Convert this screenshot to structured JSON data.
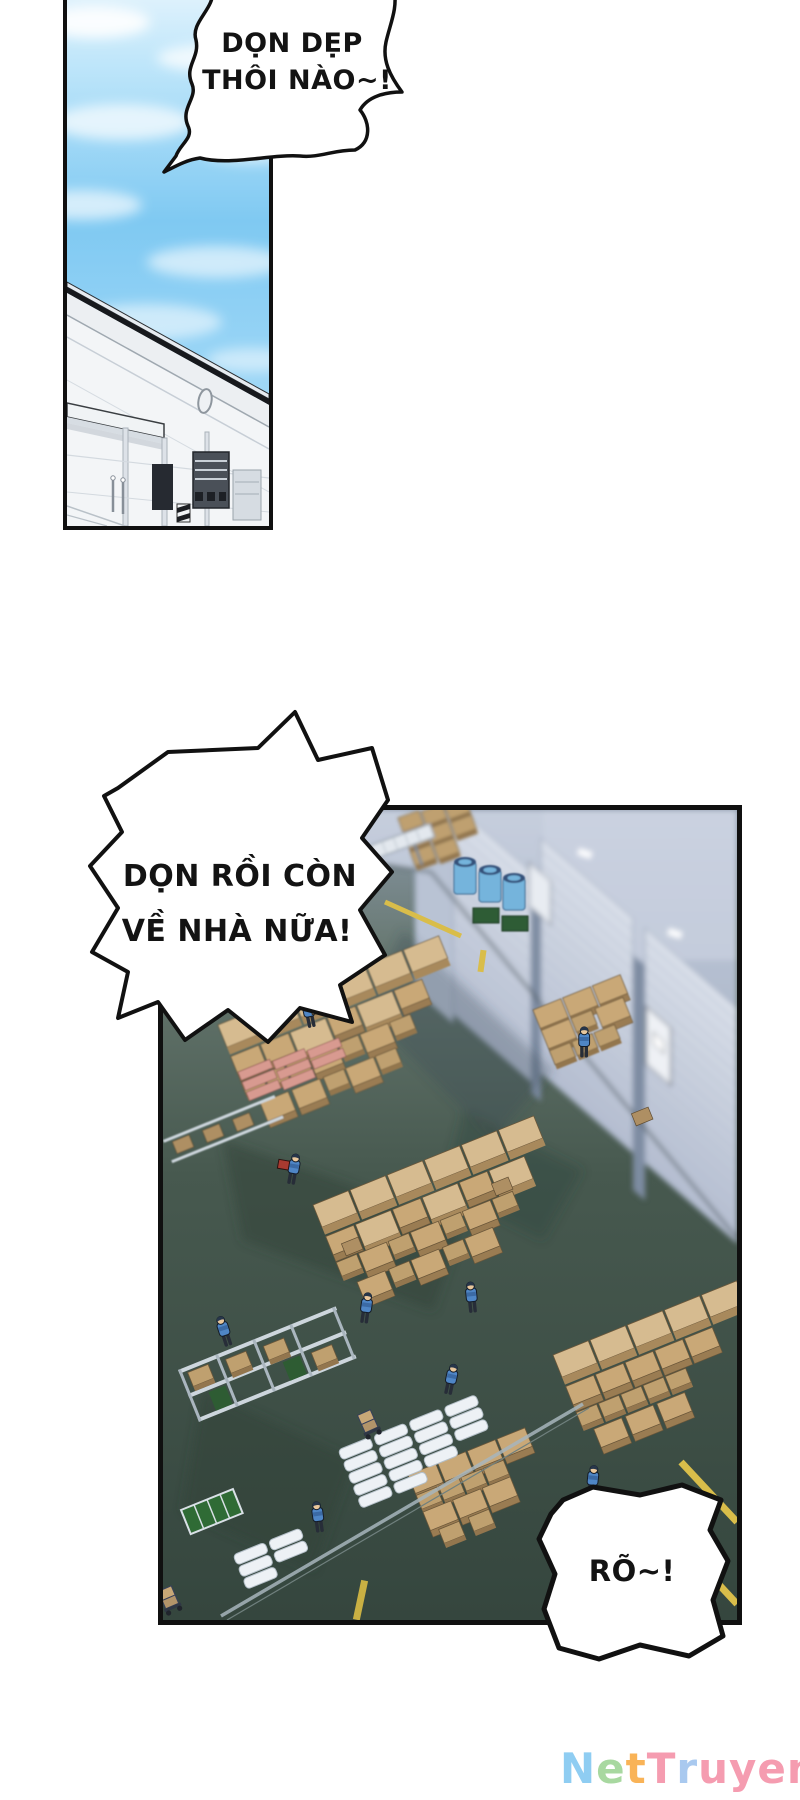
{
  "page": {
    "type": "comic-page",
    "background": "#ffffff"
  },
  "speech": {
    "bubble_top": {
      "line1": "DỌN DẸP",
      "line2": "THÔI NÀO~!"
    },
    "bubble_shout": {
      "line1": "DỌN RỒI CÒN",
      "line2": "VỀ NHÀ NỮA!"
    },
    "bubble_reply": {
      "text": "RÕ~!"
    }
  },
  "watermark": {
    "text": "NetTruyen",
    "letters": [
      {
        "char": "N",
        "style": "color:#8fcdf2"
      },
      {
        "char": "e",
        "style": "color:#a8d8a0"
      },
      {
        "char": "t",
        "style": "color:#f9b357"
      },
      {
        "char": "T",
        "style": "color:#f59cb0"
      },
      {
        "char": "r",
        "style": "color:#a9c9ef"
      },
      {
        "char": "u",
        "style": "color:#f59cb0"
      },
      {
        "char": "y",
        "style": "color:#f59cb0"
      },
      {
        "char": "e",
        "style": "color:#f59cb0"
      },
      {
        "char": "n",
        "style": "color:#f59cb0"
      }
    ]
  },
  "palette": {
    "sky": "#7fc9f2",
    "floor": "#42544b",
    "wall": "#a4b0c4",
    "roller_door": "#ccd3e0",
    "cardboard": "#c9a877",
    "worker_uniform": "#4f86c6",
    "barrel_blue": "#74b4dc",
    "safety_yellow": "#d9bd4a",
    "ink": "#131313"
  }
}
